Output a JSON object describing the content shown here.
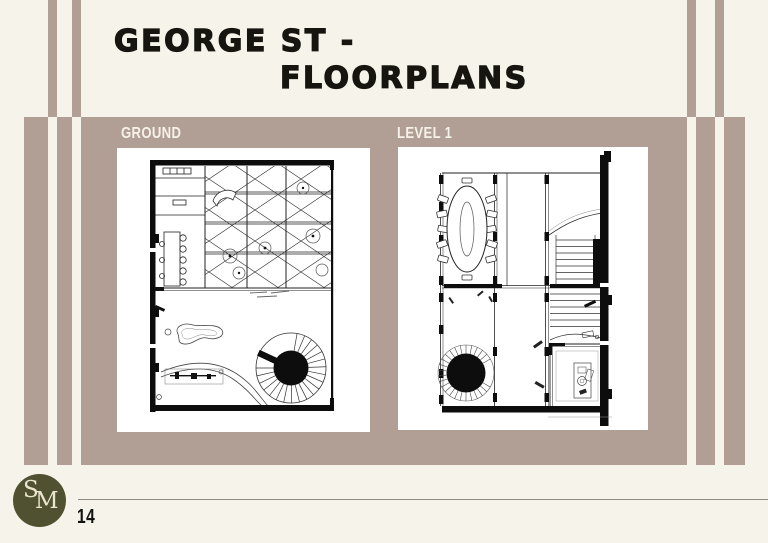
{
  "slide": {
    "title_line1": "GEORGE ST -",
    "title_line2": "FLOORPLANS",
    "page_number": "14"
  },
  "logo": {
    "letter_s": "S",
    "letter_m": "M"
  },
  "plans": [
    {
      "id": "ground",
      "label": "GROUND"
    },
    {
      "id": "level1",
      "label": "LEVEL 1"
    }
  ],
  "colors": {
    "background": "#f6f3ea",
    "panel": "#b19e94",
    "logo_circle": "#4f5130",
    "logo_text": "#ece5cf",
    "title_text": "#17150f",
    "plan_label_text": "#f5f2e9",
    "footer_line": "#8d8b84",
    "plan_card": "#ffffff",
    "plan_ink": "#111111"
  }
}
